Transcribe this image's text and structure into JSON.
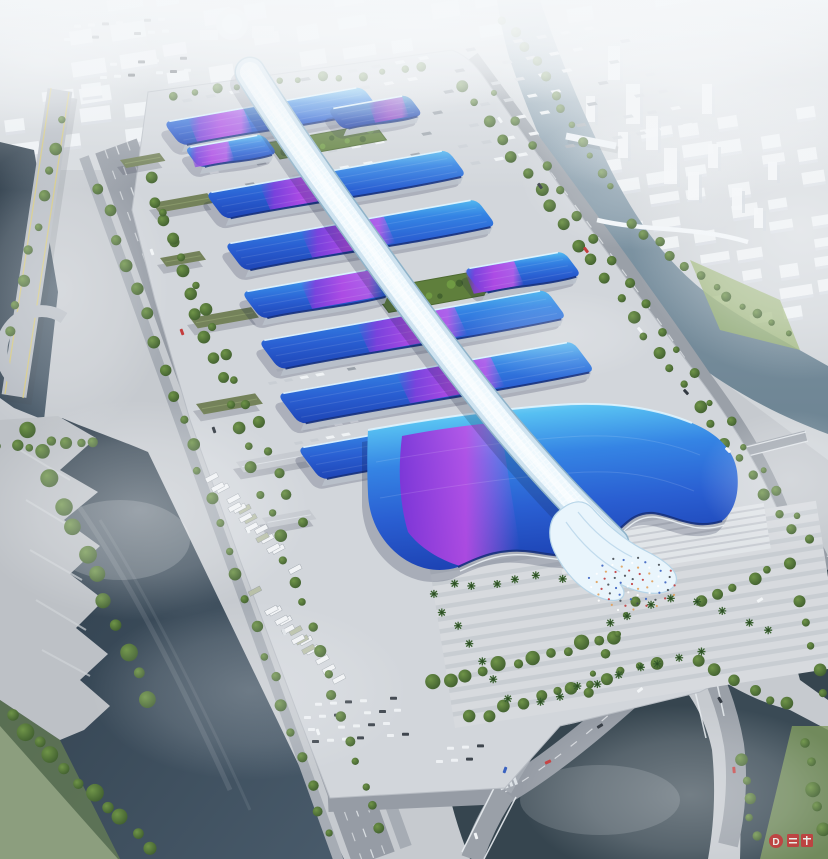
{
  "watermark": {
    "letter": "D",
    "color": "#c8373c"
  },
  "palette": {
    "fog": "#f3f6f8",
    "ground": "#c6cacf",
    "platform": "#d2d6db",
    "road": "#969ca5",
    "roadLight": "#b2b7bf",
    "lane": "#eef1f4",
    "waterDark": "#2e3d4a",
    "water": "#425464",
    "waterLight": "#7d93a3",
    "pond": "#36454f",
    "roofTop": "#90daf8",
    "roofMid": "#3a7de0",
    "roofDeep": "#2051c8",
    "roofEave": "#16317d",
    "purple": "#8a3ce0",
    "magenta": "#cb4fe8",
    "spine": "#e9f5fc",
    "spineShade": "#b7d5e8",
    "lawn": "#93ad6a",
    "courtyard": "#66873f",
    "tree": "#4a6a38",
    "treeDark": "#344f29",
    "city": "#f0f3f6",
    "cityFace": "#d8dde2",
    "shed": "#74825a",
    "red": "#c03a3c"
  },
  "scene": {
    "eU": [
      0.985,
      -0.1766
    ],
    "eV": [
      0.6,
      0.8
    ],
    "halls": [
      {
        "x": 163,
        "y": 122,
        "len": 202,
        "d": 30,
        "purple": [
          0.12,
          0.4
        ]
      },
      {
        "x": 327,
        "y": 109,
        "len": 82,
        "d": 26,
        "purple": [
          0.5,
          0.92
        ],
        "dark": true
      },
      {
        "x": 184,
        "y": 148,
        "len": 80,
        "d": 25,
        "purple": [
          0.05,
          0.55
        ]
      },
      {
        "x": 205,
        "y": 193,
        "len": 246,
        "d": 33,
        "purple": [
          0.22,
          0.52
        ]
      },
      {
        "x": 224,
        "y": 244,
        "len": 256,
        "d": 34,
        "purple": [
          0.3,
          0.63
        ]
      },
      {
        "x": 241,
        "y": 292,
        "len": 132,
        "d": 34,
        "purple": [
          0.45,
          1.0
        ]
      },
      {
        "x": 463,
        "y": 269,
        "len": 102,
        "d": 31,
        "purple": [
          0.0,
          0.5
        ]
      },
      {
        "x": 258,
        "y": 341,
        "len": 292,
        "d": 36,
        "purple": [
          0.34,
          0.68
        ]
      },
      {
        "x": 277,
        "y": 394,
        "len": 300,
        "d": 38,
        "purple": [
          0.4,
          0.72
        ]
      },
      {
        "x": 297,
        "y": 448,
        "len": 235,
        "d": 40,
        "purple": [
          0.46,
          0.78
        ]
      }
    ],
    "courtyards": [
      {
        "x": 268,
        "y": 143,
        "len": 108,
        "d": 20
      },
      {
        "x": 372,
        "y": 290,
        "len": 100,
        "d": 28
      }
    ],
    "sheds": [
      {
        "x": 152,
        "y": 203,
        "len": 56,
        "d": 12
      },
      {
        "x": 160,
        "y": 258,
        "len": 40,
        "d": 11
      },
      {
        "x": 190,
        "y": 318,
        "len": 62,
        "d": 13
      },
      {
        "x": 196,
        "y": 404,
        "len": 60,
        "d": 13
      },
      {
        "x": 236,
        "y": 462,
        "len": 70,
        "d": 13,
        "gray": true
      },
      {
        "x": 262,
        "y": 518,
        "len": 48,
        "d": 12,
        "gray": true
      },
      {
        "x": 120,
        "y": 160,
        "len": 40,
        "d": 10
      }
    ],
    "truckZones": [
      {
        "ox": 158,
        "oy": 104,
        "rows": 7,
        "cols": 20,
        "du": 24,
        "dv": 21,
        "L": 9,
        "D": 3.6
      },
      {
        "ox": 260,
        "oy": 372,
        "rows": 2,
        "cols": 6,
        "du": 16,
        "dv": 13,
        "L": 8,
        "D": 3.2
      },
      {
        "ox": 286,
        "oy": 432,
        "rows": 2,
        "cols": 5,
        "du": 16,
        "dv": 13,
        "L": 8,
        "D": 3.2
      }
    ],
    "busZones": [
      {
        "ox": 194,
        "oy": 468,
        "rows": 4,
        "cols": 5,
        "sr": 32,
        "sn": 25
      },
      {
        "ox": 248,
        "oy": 592,
        "rows": 3,
        "cols": 6,
        "sr": 30,
        "sn": 24
      }
    ],
    "carLots": [
      {
        "ox": 300,
        "oy": 704,
        "rows": 4,
        "cols": 7,
        "du": 15,
        "dv": 12
      },
      {
        "ox": 432,
        "oy": 748,
        "rows": 2,
        "cols": 4,
        "du": 15,
        "dv": 12
      },
      {
        "ox": 60,
        "oy": 26,
        "rows": 2,
        "cols": 8,
        "du": 14,
        "dv": 12
      },
      {
        "ox": 96,
        "oy": 64,
        "rows": 2,
        "cols": 7,
        "du": 14,
        "dv": 12
      }
    ],
    "treeLines": [
      {
        "x1": 460,
        "y1": 84,
        "x2": 790,
        "y2": 530,
        "n": 26,
        "r": 5
      },
      {
        "x1": 497,
        "y1": 96,
        "x2": 812,
        "y2": 540,
        "n": 20,
        "r": 4
      },
      {
        "x1": 150,
        "y1": 178,
        "x2": 382,
        "y2": 830,
        "n": 30,
        "r": 5
      },
      {
        "x1": 98,
        "y1": 186,
        "x2": 330,
        "y2": 836,
        "n": 26,
        "r": 5
      },
      {
        "x1": 30,
        "y1": 430,
        "x2": 150,
        "y2": 700,
        "n": 12,
        "r": 7
      },
      {
        "x1": 505,
        "y1": 18,
        "x2": 612,
        "y2": 186,
        "n": 12,
        "r": 4
      },
      {
        "x1": 630,
        "y1": 222,
        "x2": 786,
        "y2": 336,
        "n": 12,
        "r": 4
      },
      {
        "x1": 470,
        "y1": 718,
        "x2": 658,
        "y2": 664,
        "n": 12,
        "r": 5
      },
      {
        "x1": 700,
        "y1": 662,
        "x2": 788,
        "y2": 706,
        "n": 6,
        "r": 5
      },
      {
        "x1": 436,
        "y1": 684,
        "x2": 614,
        "y2": 636,
        "n": 12,
        "r": 6
      },
      {
        "x1": 700,
        "y1": 600,
        "x2": 788,
        "y2": 566,
        "n": 6,
        "r": 5
      },
      {
        "x1": 174,
        "y1": 96,
        "x2": 424,
        "y2": 66,
        "n": 13,
        "r": 4
      },
      {
        "x1": 10,
        "y1": 716,
        "x2": 150,
        "y2": 846,
        "n": 11,
        "r": 7
      },
      {
        "x1": 586,
        "y1": 692,
        "x2": 636,
        "y2": 600,
        "n": 6,
        "r": 4
      },
      {
        "x1": 162,
        "y1": 212,
        "x2": 300,
        "y2": 520,
        "n": 14,
        "r": 5
      },
      {
        "x1": 800,
        "y1": 600,
        "x2": 826,
        "y2": 692,
        "n": 5,
        "r": 5
      },
      {
        "x1": 802,
        "y1": 742,
        "x2": 826,
        "y2": 832,
        "n": 5,
        "r": 6
      },
      {
        "x1": 60,
        "y1": 120,
        "x2": 12,
        "y2": 330,
        "n": 9,
        "r": 5
      },
      {
        "x1": 744,
        "y1": 762,
        "x2": 754,
        "y2": 836,
        "n": 5,
        "r": 5
      },
      {
        "x1": 0,
        "y1": 448,
        "x2": 96,
        "y2": 440,
        "n": 7,
        "r": 5
      }
    ],
    "palmRows": [
      {
        "x1": 432,
        "y1": 592,
        "x2": 505,
        "y2": 700,
        "n": 7
      },
      {
        "x1": 452,
        "y1": 586,
        "x2": 560,
        "y2": 576,
        "n": 6
      },
      {
        "x1": 540,
        "y1": 700,
        "x2": 700,
        "y2": 652,
        "n": 9
      },
      {
        "x1": 608,
        "y1": 622,
        "x2": 672,
        "y2": 600,
        "n": 4
      },
      {
        "x1": 700,
        "y1": 600,
        "x2": 770,
        "y2": 630,
        "n": 4
      }
    ],
    "people": {
      "cx": 632,
      "cy": 584,
      "rx": 46,
      "ry": 28,
      "n": 64
    },
    "cars": [
      [
        500,
        120,
        54,
        0
      ],
      [
        540,
        186,
        54,
        1
      ],
      [
        586,
        250,
        52,
        2
      ],
      [
        640,
        330,
        50,
        0
      ],
      [
        686,
        392,
        48,
        1
      ],
      [
        728,
        450,
        46,
        0
      ],
      [
        152,
        252,
        70,
        0
      ],
      [
        182,
        332,
        70,
        2
      ],
      [
        214,
        430,
        71,
        1
      ],
      [
        248,
        530,
        71,
        0
      ],
      [
        284,
        632,
        71,
        3
      ],
      [
        318,
        732,
        71,
        0
      ],
      [
        640,
        690,
        -38,
        0
      ],
      [
        600,
        726,
        -32,
        1
      ],
      [
        548,
        762,
        -25,
        2
      ],
      [
        505,
        770,
        -70,
        4
      ],
      [
        760,
        600,
        -32,
        0
      ],
      [
        720,
        700,
        60,
        1
      ],
      [
        734,
        770,
        85,
        2
      ],
      [
        476,
        836,
        72,
        0
      ]
    ],
    "carColors": [
      "#f2f5f7",
      "#333a42",
      "#c43d3d",
      "#dde2e6",
      "#3a62c0"
    ],
    "cityZones": [
      {
        "ox": 64,
        "oy": 6,
        "cols": 15,
        "rows": 4,
        "cw": 34,
        "ch": 15,
        "gx": 11,
        "gy": 13,
        "rot": -9
      },
      {
        "ox": 600,
        "oy": 138,
        "cols": 8,
        "rows": 10,
        "cw": 30,
        "ch": 12,
        "gx": 9,
        "gy": 10,
        "rot": -9
      },
      {
        "ox": 2,
        "oy": 96,
        "cols": 4,
        "rows": 3,
        "cw": 30,
        "ch": 13,
        "gx": 9,
        "gy": 11,
        "rot": -7
      }
    ],
    "towers": [
      [
        608,
        46,
        12,
        34
      ],
      [
        626,
        84,
        14,
        40
      ],
      [
        646,
        116,
        12,
        34
      ],
      [
        664,
        148,
        13,
        36
      ],
      [
        688,
        172,
        11,
        28
      ],
      [
        708,
        144,
        10,
        24
      ],
      [
        618,
        132,
        10,
        26
      ],
      [
        732,
        188,
        10,
        22
      ],
      [
        754,
        208,
        9,
        20
      ],
      [
        586,
        96,
        9,
        26
      ],
      [
        702,
        84,
        10,
        30
      ],
      [
        768,
        162,
        9,
        18
      ],
      [
        540,
        60,
        8,
        24
      ],
      [
        560,
        108,
        8,
        22
      ]
    ],
    "plazaStripes": {
      "x": 430,
      "y": 562,
      "w": 392,
      "h": 168,
      "rot": -9,
      "n": 13,
      "step": 12
    }
  }
}
